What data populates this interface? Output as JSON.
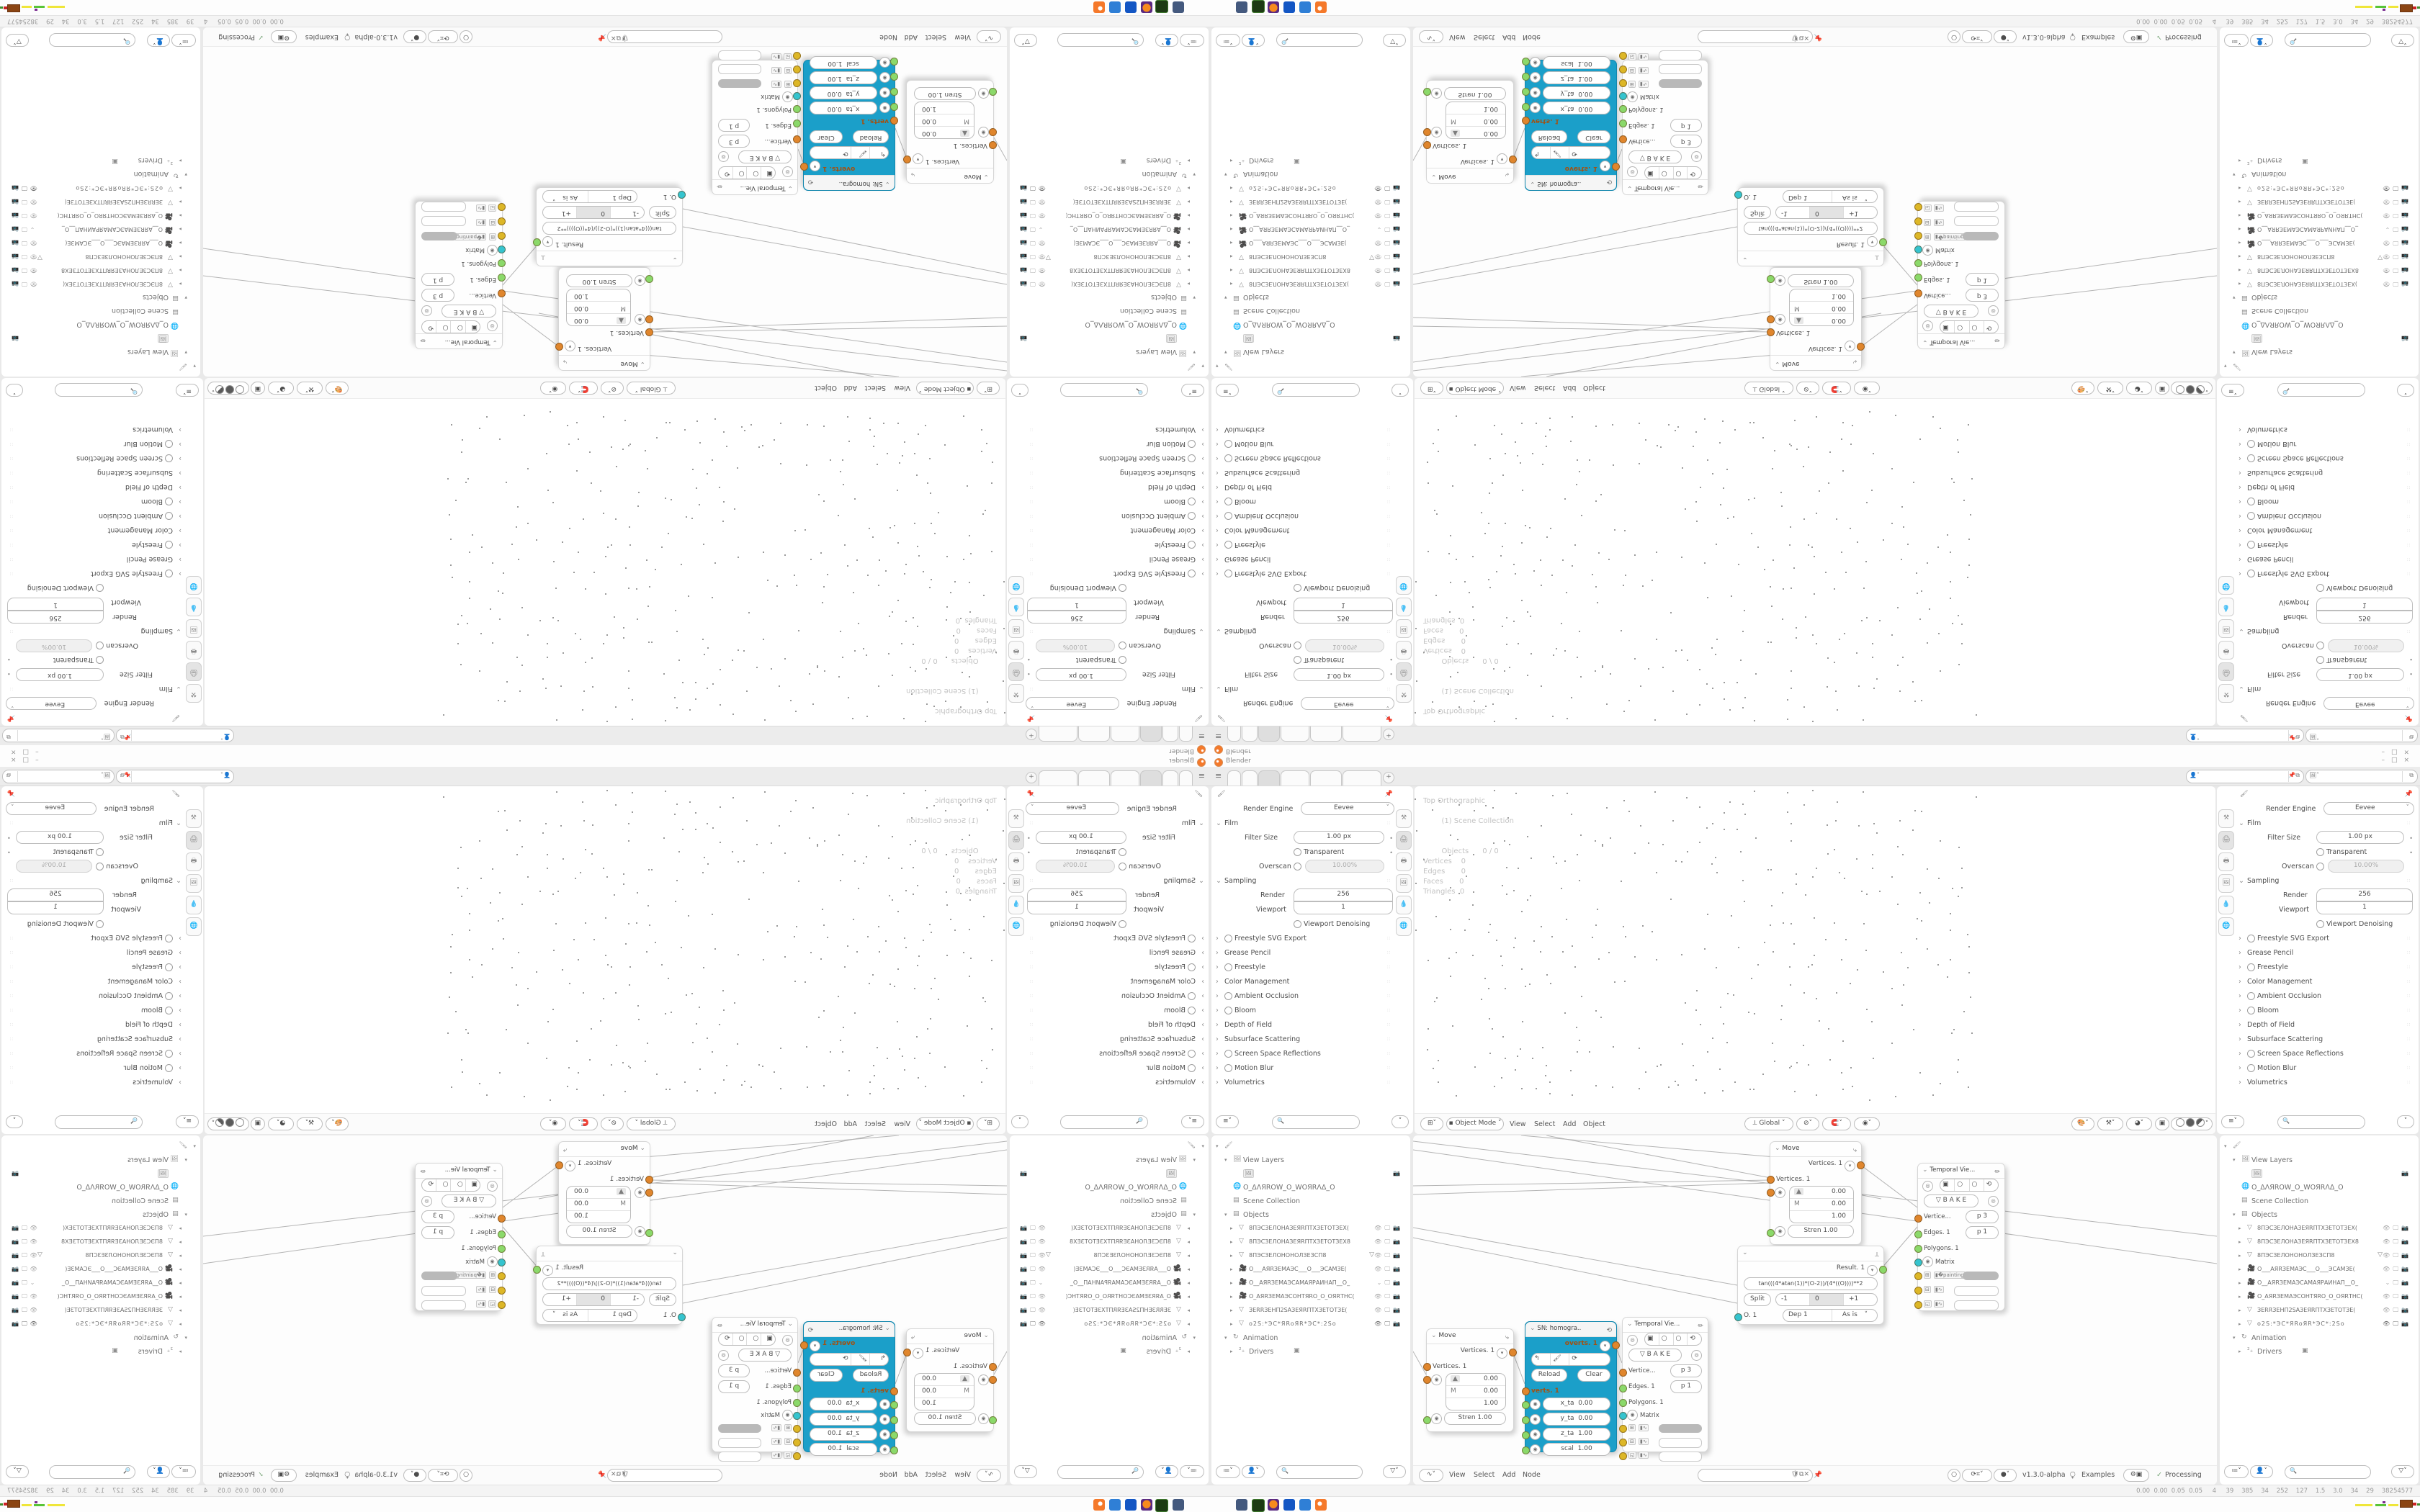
{
  "window": {
    "title": "Blender",
    "minimize": "–",
    "maximize": "□",
    "close": "×"
  },
  "topbar": {
    "menu_icon": "≡",
    "new_tab": "+"
  },
  "id_bar": {
    "field_a_value": "",
    "field_b_value": ""
  },
  "properties": {
    "render_engine_label": "Render Engine",
    "render_engine_value": "Eevee",
    "film": "Film",
    "filter_size_label": "Filter Size",
    "filter_size_value": "1.00 px",
    "transparent": "Transparent",
    "overscan_label": "Overscan",
    "overscan_value": "10.00%",
    "sampling": "Sampling",
    "render_label": "Render",
    "render_value": "256",
    "viewport_label": "Viewport",
    "viewport_value": "1",
    "viewport_denoising": "Viewport Denoising",
    "freestyle_svg": "Freestyle SVG Export",
    "grease_pencil": "Grease Pencil",
    "freestyle": "Freestyle",
    "color_management": "Color Management",
    "ambient_occlusion": "Ambient Occlusion",
    "bloom": "Bloom",
    "depth_of_field": "Depth of Field",
    "subsurface": "Subsurface Scattering",
    "ssr": "Screen Space Reflections",
    "motion_blur": "Motion Blur",
    "volumetrics": "Volumetrics"
  },
  "viewport": {
    "overlay_line1": "Top Orthographic",
    "overlay_line2": "(1) Scene Collection",
    "overlay_stats": "Objects      0 / 0\nVertices    0\nEdges       0\nFaces       0\nTriangles  0",
    "mode": "Object Mode",
    "menu_view": "View",
    "menu_select": "Select",
    "menu_add": "Add",
    "menu_object": "Object",
    "orientation": "Global"
  },
  "outliner": {
    "view_layers": "View Layers",
    "world_name": "O_ΔΛЯROW_O_WOЯRΛΔ_O",
    "scene_collection": "Scene Collection",
    "objects": "Objects",
    "obj1": "8ПЭСЗЕЛОНАЗЕЯRПТХЗЕТОТЗЕХ(",
    "obj2": "8ПЭСЗЕЛОНАЗЕЯRПТХЗЕТОТЗЕХ8",
    "obj3": "8ПЭСЗЕЛОНОНОЛЗЕЗСП8",
    "obj4": "O___АЯRЗЕМАЭС___O___ЭСАМЗЕ(",
    "obj5": "O__АЯRЗЕМАЭСАМАЯРАИНАП__O_",
    "obj6": "O_АЯRЗЕМАЭСОНТЯRO_O_OЯRТНС(",
    "obj7": "ЗЕRRЗЕНП2SАЗЕЯRПТХЗЕТОТЗЕ(",
    "obj8": "o2S:*ЭС*ЯRoЯR*ЭС*:2So",
    "animation": "Animation",
    "drivers": "Drivers"
  },
  "node_editor": {
    "menu_view": "View",
    "menu_select": "Select",
    "menu_add": "Add",
    "menu_node": "Node",
    "version": "v1.3.0-alpha",
    "examples": "Examples",
    "processing": "Processing",
    "move": {
      "title": "Move",
      "out": "Vertices. 1",
      "in": "Vertices. 1",
      "axis": "M",
      "v1": "0.00",
      "v2": "0.00",
      "v3": "1.00",
      "stren": "Stren  1.00"
    },
    "sn": {
      "title": "SN: homogra..",
      "out": "overts. 1",
      "update": "Updat...",
      "reload": "Reload",
      "clear": "Clear",
      "in": "verts. 1",
      "f1l": "x_ta",
      "f1v": "0.00",
      "f2l": "y_ta",
      "f2v": "0.00",
      "f3l": "z_ta",
      "f3v": "1.00",
      "f4l": "scal",
      "f4v": "1.00"
    },
    "temporal": {
      "title": "Temporal Vie...",
      "bake": "B A K E",
      "vert_l": "Vertice...",
      "vert_v": "p  3",
      "edge_l": "Edges. 1",
      "edge_v": "p  1",
      "poly_l": "Polygons. 1",
      "matrix_l": "Matrix"
    },
    "math": {
      "out": "Result. 1",
      "formula": "tan(((4*atan(1))*(O-2))/(4*((O))))**2",
      "split": "Split",
      "minus": "-1",
      "zero": "0",
      "plus": "+1",
      "o_label": "O. 1",
      "dep": "Dep  1",
      "as_is": "As is"
    }
  },
  "status_bar": "0.00  0.00  0.05  0.05     4     39    385    34    252    127    1.5    3.0    34    29    38254577",
  "taskbar_apps": [
    "screen-capture",
    "recorder",
    "firefox",
    "archive-tool",
    "image-viewer",
    "blender"
  ],
  "colors": {
    "accent_node": "#1b9fc9",
    "socket_orange": "#e0862d",
    "socket_green": "#8bd96a",
    "socket_cyan": "#35c4cf",
    "socket_yellow": "#ddb727",
    "blender_orange": "#f5792a"
  }
}
